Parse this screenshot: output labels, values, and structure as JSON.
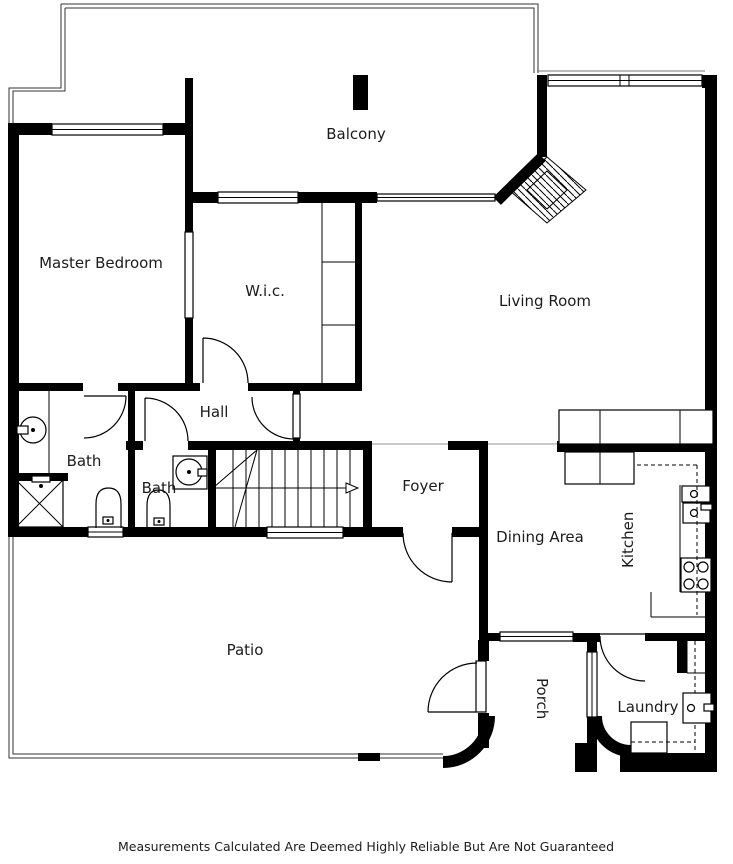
{
  "floorplan": {
    "title": "Floor Plan",
    "rooms": [
      {
        "id": "balcony",
        "label": "Balcony"
      },
      {
        "id": "master-bedroom",
        "label": "Master Bedroom"
      },
      {
        "id": "wic",
        "label": "W.i.c."
      },
      {
        "id": "living-room",
        "label": "Living Room"
      },
      {
        "id": "hall",
        "label": "Hall"
      },
      {
        "id": "bath-1",
        "label": "Bath"
      },
      {
        "id": "bath-2",
        "label": "Bath"
      },
      {
        "id": "foyer",
        "label": "Foyer"
      },
      {
        "id": "dining-area",
        "label": "Dining Area"
      },
      {
        "id": "kitchen",
        "label": "Kitchen"
      },
      {
        "id": "patio",
        "label": "Patio"
      },
      {
        "id": "porch",
        "label": "Porch"
      },
      {
        "id": "laundry",
        "label": "Laundry"
      }
    ],
    "disclaimer": "Measurements Calculated Are Deemed Highly Reliable But Are Not Guaranteed",
    "colors": {
      "wall": "#000000",
      "line": "#000000",
      "text": "#1c1c1c",
      "open_boundary": "#c9c9c9",
      "background": "#ffffff"
    },
    "fixtures": [
      "stairs-up-arrow",
      "fireplace",
      "shower",
      "toilet",
      "sink",
      "stove",
      "kitchen-sink",
      "washer"
    ]
  }
}
